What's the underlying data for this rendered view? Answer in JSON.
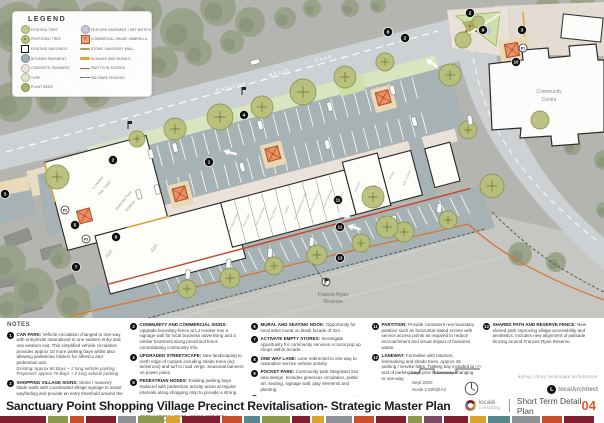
{
  "legend": {
    "title": "LEGEND",
    "col1": [
      {
        "label": "EXISTING TREE",
        "swatch": "circle",
        "color": "#c3ca8c"
      },
      {
        "label": "PROPOSED TREE",
        "swatch": "circle-dot",
        "color": "#b9c178"
      },
      {
        "label": "EXISTING BUILDINGS",
        "swatch": "square-outline",
        "color": "#ffffff"
      },
      {
        "label": "BITUMEN PAVEMENT",
        "swatch": "circle",
        "color": "#9db0b4"
      },
      {
        "label": "CONCRETE PAVEMENT",
        "swatch": "circle",
        "color": "#eee3da"
      },
      {
        "label": "TURF",
        "swatch": "circle",
        "color": "#dde8c5"
      },
      {
        "label": "PLANT BEDS",
        "swatch": "circle",
        "color": "#a9b264"
      }
    ],
    "col2": [
      {
        "label": "FEATURE PAVEMENT / ART MOTIFS",
        "swatch": "circle",
        "color": "#c6c6e0"
      },
      {
        "label": "COMMERCIAL SHADE UMBRELLA",
        "swatch": "umbrella",
        "color": "#efa07b"
      },
      {
        "label": "STONE / MASONRY WALL",
        "swatch": "bar",
        "color": "#a5a05e"
      },
      {
        "label": "SIGNAGE AND MURALS",
        "swatch": "bar",
        "color": "#e0a238"
      },
      {
        "label": "PARTITION SCREEN",
        "swatch": "line",
        "color": "#c2542f"
      },
      {
        "label": "PALISADE FENCING",
        "swatch": "dashed",
        "color": "#6b6b66"
      }
    ]
  },
  "notes": {
    "header": "NOTES",
    "columns": [
      [
        {
          "n": "1",
          "t": "CAR PARK:",
          "b": "Vehicle circulation changed to one-way with entry/exits rationalised to one eastern entry and one western exit. This simplified vehicle circulation provides approx 10 more parking bays whilst also allowing pedestrian blisters for alfresco and pedestrian use.",
          "e": [
            "Existing: approx 60 Bays + 2 long vehicle parking",
            "Proposed: approx 70 Bays + 2 long vehicle parking"
          ]
        },
        {
          "n": "2",
          "t": "SHOPPING VILLAGE SIGNS:",
          "b": "Stone / masonry blade walls with coordinated village signage to assist wayfinding and provide an entry threshold around the shopping village area.",
          "e": []
        }
      ],
      [
        {
          "n": "3",
          "t": "COMMUNITY AND COMMERCIAL SIGNS:",
          "b": "Upgrade boundary fence at LJ Hooker into a signage wall for local business advertising and a similar treatment along preschool fence consolidating community info.",
          "e": []
        },
        {
          "n": "4",
          "t": "UPGRADED STREETSCAPE:",
          "b": "New landscaping to north edge of carpark including shade trees (eg: tuckeroos) and turf to road verge. Seasonal banners on power poles.",
          "e": []
        },
        {
          "n": "5",
          "t": "PEDESTRIAN NODES:",
          "b": "Existing parking bays replaced with pedestrian activity areas at regular intervals along shopping strip to provide a strong and consistent aesthetic character and better pedestrian amenity. Nodes include coloured commercial umbrellas, street furniture, planters, alfresco seating options, feature pavement / colouring / art motifs.",
          "e": []
        }
      ],
      [
        {
          "n": "6",
          "t": "MURAL AND SEATING NOOK:",
          "b": "Opportunity for local artist mural on blank facade of IGA.",
          "e": []
        },
        {
          "n": "7",
          "t": "ACTIVATE EMPTY STORES:",
          "b": "Investigate opportunity for community services or local pop up shops within arcade.",
          "e": []
        },
        {
          "n": "8",
          "t": "ONE WAY LANE:",
          "b": "Lane redirected to one way to rationalise service vehicle activity.",
          "e": []
        },
        {
          "n": "9",
          "t": "POCKET PARK:",
          "b": "Community park integrated into new design. Includes generous circulation, public art, seating, signage wall, play elements and planting.",
          "e": []
        },
        {
          "n": "10",
          "t": "COMMUNITY CENTRE FORECOURT:",
          "b": "Upgraded entry consistent with new pedestrian node pavement and umbrella.",
          "e": []
        }
      ],
      [
        {
          "n": "11",
          "t": "PARTITION:",
          "b": "Provide consistent rear boundary partition such as horizontal slated screen with service access points as required to reduce encroachment and visual impact of business waste.",
          "e": []
        },
        {
          "n": "12",
          "t": "LANEWAY:",
          "b": "Formalise with bitumen, linemarking and shade trees. Approx 45 parking / service bays. Turning bay included at end of parking bays prior to laneway changing to one-way.",
          "e": []
        }
      ],
      [
        {
          "n": "13",
          "t": "SHARED PATH AND RESERVE FENCE:",
          "b": "New shared path improving village accessibility and aesthetics. Includes new alignment of palisade fencing around Frances Ryan Reserve.",
          "e": []
        }
      ]
    ]
  },
  "footer": {
    "title": "Sanctuary Point Shopping Village Precinct Revitalisation- Strategic Master Plan",
    "consultant_name": "localé",
    "consultant_sub": "consulting",
    "plan_label": "Short Term Detail Plan",
    "page_number": "04",
    "date": "Sept 2020",
    "scale": "Scale 1:500@A3",
    "scalebar_labels": [
      "0",
      "5",
      "10",
      "20m"
    ],
    "credit": "ayling | drury landscape architecture",
    "architect_logo_initial": "L",
    "architect_logo_name": "localArchitect",
    "strip": [
      [
        46,
        "#801f2f"
      ],
      [
        20,
        "#8d9a4d"
      ],
      [
        14,
        "#c8502c"
      ],
      [
        30,
        "#801f2f"
      ],
      [
        18,
        "#8f9294"
      ],
      [
        26,
        "#8d9a4d"
      ],
      [
        14,
        "#d9a52f"
      ],
      [
        38,
        "#801f2f"
      ],
      [
        20,
        "#c8502c"
      ],
      [
        16,
        "#57898c"
      ],
      [
        28,
        "#8d9a4d"
      ],
      [
        18,
        "#801f2f"
      ],
      [
        12,
        "#d9a52f"
      ],
      [
        26,
        "#8f9294"
      ],
      [
        20,
        "#c8502c"
      ],
      [
        30,
        "#801f2f"
      ],
      [
        14,
        "#8d9a4d"
      ],
      [
        18,
        "#7b4a63"
      ],
      [
        24,
        "#801f2f"
      ],
      [
        16,
        "#d9a52f"
      ],
      [
        22,
        "#57898c"
      ],
      [
        28,
        "#8f9294"
      ],
      [
        20,
        "#c8502c"
      ],
      [
        30,
        "#801f2f"
      ]
    ]
  },
  "map": {
    "colors": {
      "aerial": "#b4b5b1",
      "canopy": "#98a086",
      "canopy_dark": "#868e74",
      "road": "#cdd1d3",
      "bitumen": "#a7b2b4",
      "concrete": "#eae1d8",
      "turf": "#d9e4c0",
      "plantbed": "#a9b264",
      "building": "#fdfdfa",
      "tree": "#b8bf79",
      "tree_stroke": "#8a9550",
      "umbrella": "#ee9065",
      "umbrella_stroke": "#b0552b",
      "partition": "#c2452a",
      "signage": "#e0a238",
      "palisade": "#5a5a56",
      "node": "#e9d9b6",
      "feature": "#c6c6e0",
      "reserve": "#c6c7c3"
    },
    "labels": [
      {
        "t": "Paradise",
        "f": "g",
        "x": 232,
        "y": 88,
        "r": -15,
        "s": 5,
        "c": "#ffffff",
        "ls": 1.5
      },
      {
        "t": "Beach",
        "f": "g",
        "x": 280,
        "y": 74,
        "r": -15,
        "s": 5,
        "c": "#ffffff",
        "ls": 1.5
      },
      {
        "t": "Road",
        "f": "g",
        "x": 324,
        "y": 60,
        "r": -15,
        "s": 5,
        "c": "#ffffff",
        "ls": 1.5
      },
      {
        "t": "Community",
        "f": "g",
        "x": 549,
        "y": 93,
        "r": 0,
        "s": 5,
        "c": "#8a8a85",
        "ls": 0
      },
      {
        "t": "Centre",
        "f": "g",
        "x": 549,
        "y": 101,
        "r": 0,
        "s": 5,
        "c": "#8a8a85",
        "ls": 0
      },
      {
        "t": "Francis Ryan",
        "f": "g",
        "x": 333,
        "y": 296,
        "r": 0,
        "s": 5.2,
        "c": "#6f6f6a",
        "ls": 0
      },
      {
        "t": "Reserve",
        "f": "g",
        "x": 333,
        "y": 303,
        "r": 0,
        "s": 5.2,
        "c": "#6f6f6a",
        "ls": 0
      },
      {
        "t": "LJ Hooker",
        "f": "l",
        "x": 92,
        "y": 38,
        "r": -35,
        "s": 3.4,
        "c": "#8a8a85",
        "ls": 0
      },
      {
        "t": "Real Estate",
        "f": "l",
        "x": 97,
        "y": 45,
        "r": -35,
        "s": 3.4,
        "c": "#8a8a85",
        "ls": 0
      },
      {
        "t": "Sanctuary Point",
        "f": "l",
        "x": 112,
        "y": 62,
        "r": -35,
        "s": 3.4,
        "c": "#8a8a85",
        "ls": 0
      },
      {
        "t": "Seafood",
        "f": "l",
        "x": 117,
        "y": 69,
        "r": -35,
        "s": 3.4,
        "c": "#8a8a85",
        "ls": 0
      },
      {
        "t": "IGA",
        "f": "l",
        "x": 85,
        "y": 110,
        "r": -38,
        "s": 5,
        "c": "#9a9a95",
        "ls": 0
      },
      {
        "t": "IGA",
        "f": "l",
        "x": 130,
        "y": 116,
        "r": -38,
        "s": 5,
        "c": "#9a9a95",
        "ls": 0
      },
      {
        "t": "Eden's Real Estate",
        "f": "l",
        "x": 212,
        "y": 112,
        "r": -52,
        "s": 2.7,
        "c": "#9a9a95",
        "ls": 0
      },
      {
        "t": "Dan's Cafe",
        "f": "l",
        "x": 226,
        "y": 112,
        "r": -52,
        "s": 2.7,
        "c": "#9a9a95",
        "ls": 0
      },
      {
        "t": "Holy Cow Kebab",
        "f": "l",
        "x": 240,
        "y": 112,
        "r": -52,
        "s": 2.7,
        "c": "#9a9a95",
        "ls": 0
      },
      {
        "t": "King Tobacco",
        "f": "l",
        "x": 254,
        "y": 112,
        "r": -52,
        "s": 2.7,
        "c": "#9a9a95",
        "ls": 0
      },
      {
        "t": "Barber",
        "f": "l",
        "x": 268,
        "y": 112,
        "r": -52,
        "s": 2.7,
        "c": "#9a9a95",
        "ls": 0
      },
      {
        "t": "Chop Between the Flags",
        "f": "l",
        "x": 282,
        "y": 112,
        "r": -52,
        "s": 2.7,
        "c": "#9a9a95",
        "ls": 0
      },
      {
        "t": "The Point Pizzeria",
        "f": "l",
        "x": 296,
        "y": 112,
        "r": -52,
        "s": 2.7,
        "c": "#9a9a95",
        "ls": 0
      },
      {
        "t": "Cafe / Patisserie",
        "f": "l",
        "x": 310,
        "y": 112,
        "r": -52,
        "s": 2.7,
        "c": "#9a9a95",
        "ls": 0
      },
      {
        "t": "Bakery",
        "f": "l",
        "x": 324,
        "y": 112,
        "r": -52,
        "s": 2.7,
        "c": "#9a9a95",
        "ls": 0
      },
      {
        "t": "Butchery",
        "f": "l",
        "x": 342,
        "y": 108,
        "r": -52,
        "s": 2.9,
        "c": "#9a9a95",
        "ls": 0
      },
      {
        "t": "RWS",
        "f": "l",
        "x": 354,
        "y": 114,
        "r": 0,
        "s": 5,
        "c": "#9a9a95",
        "ls": 0
      },
      {
        "t": "Florist",
        "f": "l",
        "x": 378,
        "y": 106,
        "r": -52,
        "s": 2.9,
        "c": "#9a9a95",
        "ls": 0
      },
      {
        "t": "ANC Liquors",
        "f": "l",
        "x": 392,
        "y": 112,
        "r": -52,
        "s": 2.9,
        "c": "#9a9a95",
        "ls": 0
      }
    ],
    "markers": [
      {
        "n": "1",
        "x": 209,
        "y": 162
      },
      {
        "n": "2",
        "x": 113,
        "y": 160
      },
      {
        "n": "2",
        "x": 405,
        "y": 38
      },
      {
        "n": "2",
        "x": 470,
        "y": 13
      },
      {
        "n": "3",
        "x": 5,
        "y": 194
      },
      {
        "n": "3",
        "x": 522,
        "y": 30
      },
      {
        "n": "4",
        "x": 244,
        "y": 115
      },
      {
        "n": "5",
        "x": 75,
        "y": 225
      },
      {
        "n": "6",
        "x": 116,
        "y": 237
      },
      {
        "n": "7",
        "x": 76,
        "y": 267
      },
      {
        "n": "8",
        "x": 388,
        "y": 32
      },
      {
        "n": "9",
        "x": 483,
        "y": 30
      },
      {
        "n": "10",
        "x": 516,
        "y": 62
      },
      {
        "n": "11",
        "x": 338,
        "y": 200
      },
      {
        "n": "12",
        "x": 340,
        "y": 227
      },
      {
        "n": "13",
        "x": 340,
        "y": 258
      }
    ],
    "photo_markers": [
      {
        "n": "P1",
        "x": 523,
        "y": 48
      },
      {
        "n": "P2",
        "x": 65,
        "y": 210
      },
      {
        "n": "P3",
        "x": 86,
        "y": 239
      }
    ],
    "umbrellas_local": [
      [
        70,
        236
      ],
      [
        168,
        239
      ],
      [
        268,
        224
      ],
      [
        389,
        198
      ]
    ],
    "umbrellas_global": [
      [
        512,
        50
      ]
    ],
    "trees": [
      [
        57,
        177,
        12,
        "p"
      ],
      [
        137,
        139,
        8,
        "p"
      ],
      [
        175,
        129,
        11,
        "p"
      ],
      [
        220,
        117,
        13,
        "p"
      ],
      [
        262,
        107,
        11,
        "p"
      ],
      [
        303,
        92,
        13,
        "p"
      ],
      [
        345,
        77,
        11,
        "p"
      ],
      [
        385,
        62,
        9,
        "p"
      ],
      [
        450,
        75,
        11,
        "p"
      ],
      [
        468,
        130,
        9,
        "p"
      ],
      [
        492,
        186,
        12,
        "p"
      ],
      [
        187,
        289,
        9,
        "p"
      ],
      [
        230,
        278,
        10,
        "p"
      ],
      [
        274,
        266,
        9,
        "p"
      ],
      [
        317,
        255,
        10,
        "p"
      ],
      [
        361,
        243,
        9,
        "p"
      ],
      [
        404,
        232,
        10,
        "p"
      ],
      [
        448,
        220,
        9,
        "p"
      ],
      [
        373,
        197,
        11,
        "p"
      ],
      [
        387,
        227,
        11,
        "p"
      ],
      [
        463,
        40,
        8,
        "e"
      ],
      [
        478,
        22,
        6,
        "e"
      ],
      [
        540,
        120,
        9,
        "e"
      ]
    ],
    "canopy": [
      [
        18,
        28,
        26
      ],
      [
        58,
        14,
        22
      ],
      [
        100,
        26,
        24
      ],
      [
        142,
        12,
        20
      ],
      [
        182,
        30,
        22
      ],
      [
        218,
        8,
        18
      ],
      [
        250,
        22,
        15
      ],
      [
        32,
        66,
        24
      ],
      [
        78,
        64,
        20
      ],
      [
        122,
        60,
        18
      ],
      [
        162,
        62,
        16
      ],
      [
        12,
        102,
        20
      ],
      [
        52,
        98,
        16
      ],
      [
        96,
        94,
        14
      ],
      [
        198,
        52,
        14
      ],
      [
        232,
        42,
        12
      ],
      [
        285,
        18,
        11
      ],
      [
        312,
        8,
        9
      ],
      [
        350,
        8,
        9
      ],
      [
        378,
        5,
        8
      ],
      [
        548,
        12,
        15
      ],
      [
        582,
        6,
        13
      ],
      [
        600,
        34,
        14
      ],
      [
        596,
        118,
        12
      ],
      [
        572,
        146,
        9
      ],
      [
        604,
        160,
        10
      ],
      [
        8,
        262,
        18
      ],
      [
        34,
        288,
        20
      ],
      [
        74,
        302,
        18
      ],
      [
        116,
        312,
        14
      ],
      [
        10,
        306,
        14
      ],
      [
        148,
        318,
        10
      ],
      [
        60,
        258,
        11
      ],
      [
        520,
        254,
        12
      ],
      [
        556,
        262,
        10
      ],
      [
        590,
        240,
        9
      ],
      [
        604,
        210,
        8
      ]
    ],
    "houses": [
      [
        18,
        238,
        26,
        12,
        -20
      ],
      [
        52,
        252,
        22,
        11,
        -15
      ],
      [
        10,
        280,
        24,
        12,
        -10
      ],
      [
        66,
        282,
        18,
        10,
        -22
      ],
      [
        28,
        306,
        26,
        12,
        -15
      ],
      [
        96,
        300,
        20,
        10,
        -18
      ]
    ],
    "cars_local": [
      [
        150,
        193,
        0
      ],
      [
        175,
        193,
        0
      ],
      [
        263,
        193,
        0
      ],
      [
        335,
        193,
        0
      ],
      [
        400,
        193,
        0
      ],
      [
        128,
        229,
        0
      ],
      [
        147,
        229,
        0
      ],
      [
        235,
        229,
        0
      ],
      [
        323,
        229,
        0
      ],
      [
        413,
        229,
        0
      ],
      [
        155,
        319,
        20
      ],
      [
        197,
        319,
        20
      ],
      [
        240,
        319,
        20
      ],
      [
        283,
        319,
        20
      ],
      [
        368,
        319,
        20
      ],
      [
        415,
        319,
        20
      ]
    ],
    "cars_global": [
      [
        255,
        62,
        -105
      ],
      [
        470,
        120,
        -10
      ]
    ],
    "arrows": [
      [
        228,
        152,
        195
      ],
      [
        100,
        188,
        195
      ],
      [
        430,
        62,
        215
      ],
      [
        346,
        216,
        15
      ],
      [
        352,
        227,
        195
      ]
    ],
    "poles": [
      [
        242,
        95
      ],
      [
        128,
        129
      ]
    ]
  }
}
